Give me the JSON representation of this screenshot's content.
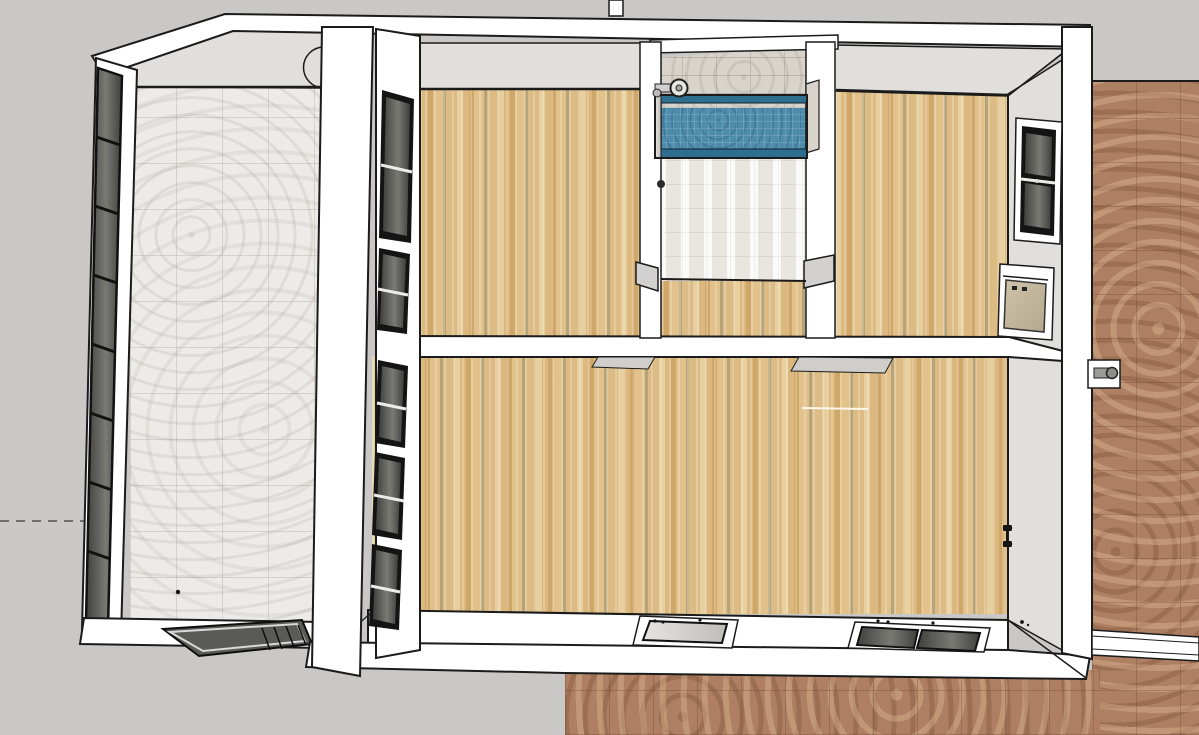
{
  "viewport": {
    "width": 1199,
    "height": 735,
    "view": "top-down-3d-model"
  },
  "scene": {
    "type": "architectural-model-top-view",
    "rooms": [
      {
        "id": "atrium",
        "floor": "marble-tile"
      },
      {
        "id": "bedroom-left",
        "floor": "wood-plank"
      },
      {
        "id": "bathroom",
        "floor": "white-tile",
        "fixtures": [
          "bathtub-blue-tile",
          "faucet",
          "door-knob"
        ]
      },
      {
        "id": "bedroom-right",
        "floor": "wood-plank",
        "fixtures": [
          "window-dark",
          "window-beige"
        ]
      },
      {
        "id": "living-room",
        "floor": "wood-plank",
        "fixtures": [
          "bottom-window-light",
          "bottom-window-double-dark"
        ]
      }
    ],
    "exterior": [
      "terracotta-ground-right",
      "terracotta-ground-bottom",
      "fence-strip-top",
      "fence-strip-right",
      "hose-bib",
      "roof-panel-dark",
      "dashed-reference-line"
    ]
  },
  "colors": {
    "background": "#c9c8c6",
    "outline": "#1b1b1b",
    "wall_white": "#ffffff",
    "wall_gray_face": "#e0dfdd",
    "wall_gray_dark": "#d2d1cf",
    "threshold_gray": "#cfcecb",
    "frame_black": "#141414",
    "wood_floor": "#dcbc84",
    "wood_light": "#e7cfa0",
    "wood_mid": "#dcb87e",
    "wood_dark": "#cfa768",
    "wood_light2": "#e2c18b",
    "wood_olive": "#b5a47a",
    "marble_floor": "#edebe7",
    "terracotta": "#ae7f62",
    "bath_tile": "#f2f0ec",
    "bath_wall": "#d8d3cb",
    "tub_blue": "#4e8cac",
    "tub_blue_dark": "#2e6e8e",
    "glass_dark_a": "#3f3f3d",
    "glass_dark_b": "#7a7a74",
    "glass_light_a": "#e6e4e0",
    "glass_light_b": "#bfbdb8",
    "glass_beige_a": "#cec3aa",
    "glass_beige_b": "#b4a88d",
    "panel_dark": "#5a5a57",
    "metal_gray": "#9a9a98",
    "dash_gray": "#6f6f6d"
  }
}
